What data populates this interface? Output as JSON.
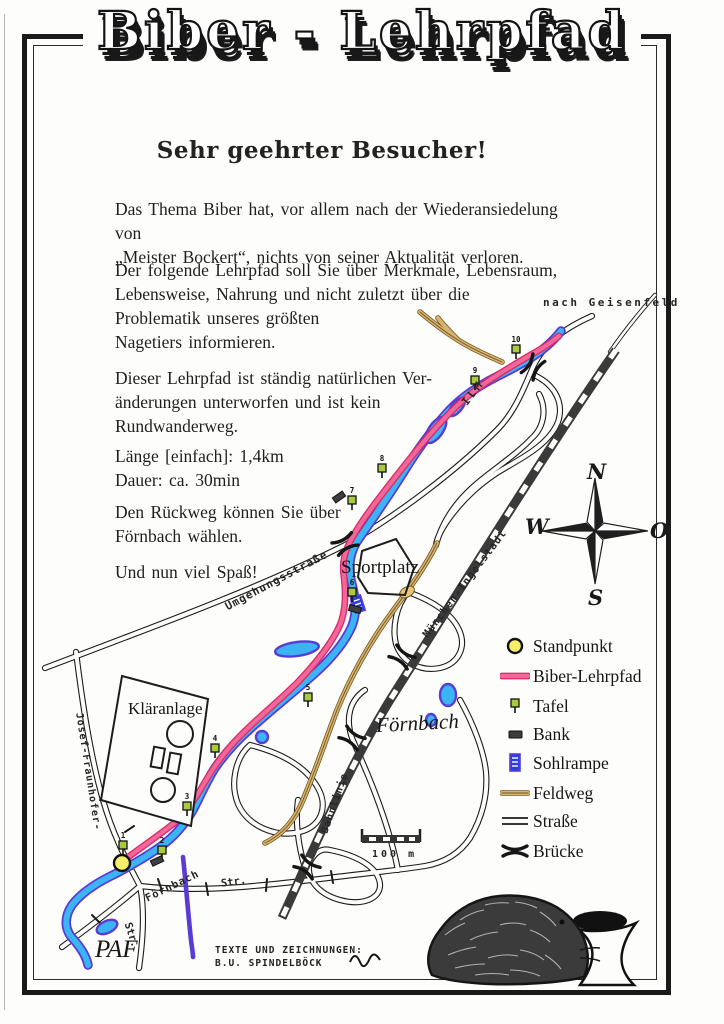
{
  "page": {
    "title_line": "Biber - Lehrpfad"
  },
  "greeting": "Sehr geehrter Besucher!",
  "paragraphs": {
    "p1": "Das Thema Biber hat, vor allem nach der Wiederansiedelung von\n„Meister Bockert“, nichts von seiner Aktualität verloren.",
    "p2": "Der folgende Lehrpfad soll Sie über Merkmale, Lebensraum,\nLebensweise, Nahrung und nicht zuletzt über die\nProblematik unseres größten\nNagetiers informieren.",
    "p3": "Dieser Lehrpfad ist ständig natürlichen Ver-\nänderungen unterworfen und ist kein\nRundwanderweg.",
    "p4": "Länge [einfach]: 1,4km\nDauer: ca. 30min",
    "p5": "Den Rückweg können Sie über\nFörnbach wählen.",
    "p6": "Und nun viel Spaß!"
  },
  "map": {
    "labels": {
      "nach_geisenfeld": "nach Geisenfeld",
      "ilm": "ILM",
      "umgehungsstrasse": "Umgehungsstraße",
      "sportplatz": "Sportplatz",
      "muenchen_ingolstadt": "München-Ingolstadt",
      "bahnlinie": "Bahnlinie",
      "foernbach_river": "Förnbach",
      "klaeranlage": "Kläranlage",
      "josef_fraunhofer": "Josef-Fraunhofer-",
      "foernbach_street": "Förnbach",
      "street_abbr_1": "Str.",
      "street_abbr_2": "Str.",
      "paf": "PAF",
      "scale": "100 m"
    },
    "compass": {
      "n": "N",
      "w": "W",
      "o": "O",
      "s": "S"
    },
    "tafel_numbers": [
      "1",
      "2",
      "3",
      "4",
      "5",
      "6",
      "7",
      "8",
      "9",
      "10"
    ]
  },
  "legend": {
    "items": [
      {
        "label": "Standpunkt"
      },
      {
        "label": "Biber-Lehrpfad"
      },
      {
        "label": "Tafel"
      },
      {
        "label": "Bank"
      },
      {
        "label": "Sohlrampe"
      },
      {
        "label": "Feldweg"
      },
      {
        "label": "Straße"
      },
      {
        "label": "Brücke"
      }
    ]
  },
  "credit": "TEXTE UND ZEICHNUNGEN:\nB.U. SPINDELBÖCK",
  "colors": {
    "trail": "#f0679a",
    "trail_dark": "#d92a67",
    "river": "#3ab4f2",
    "river_edge": "#5a3bd4",
    "feldweg": "#d9b26b",
    "feldweg_dark": "#70592a",
    "tafel": "#a9c93f",
    "standpunkt": "#f4ee6b",
    "sohlrampe": "#2b3fe0"
  }
}
